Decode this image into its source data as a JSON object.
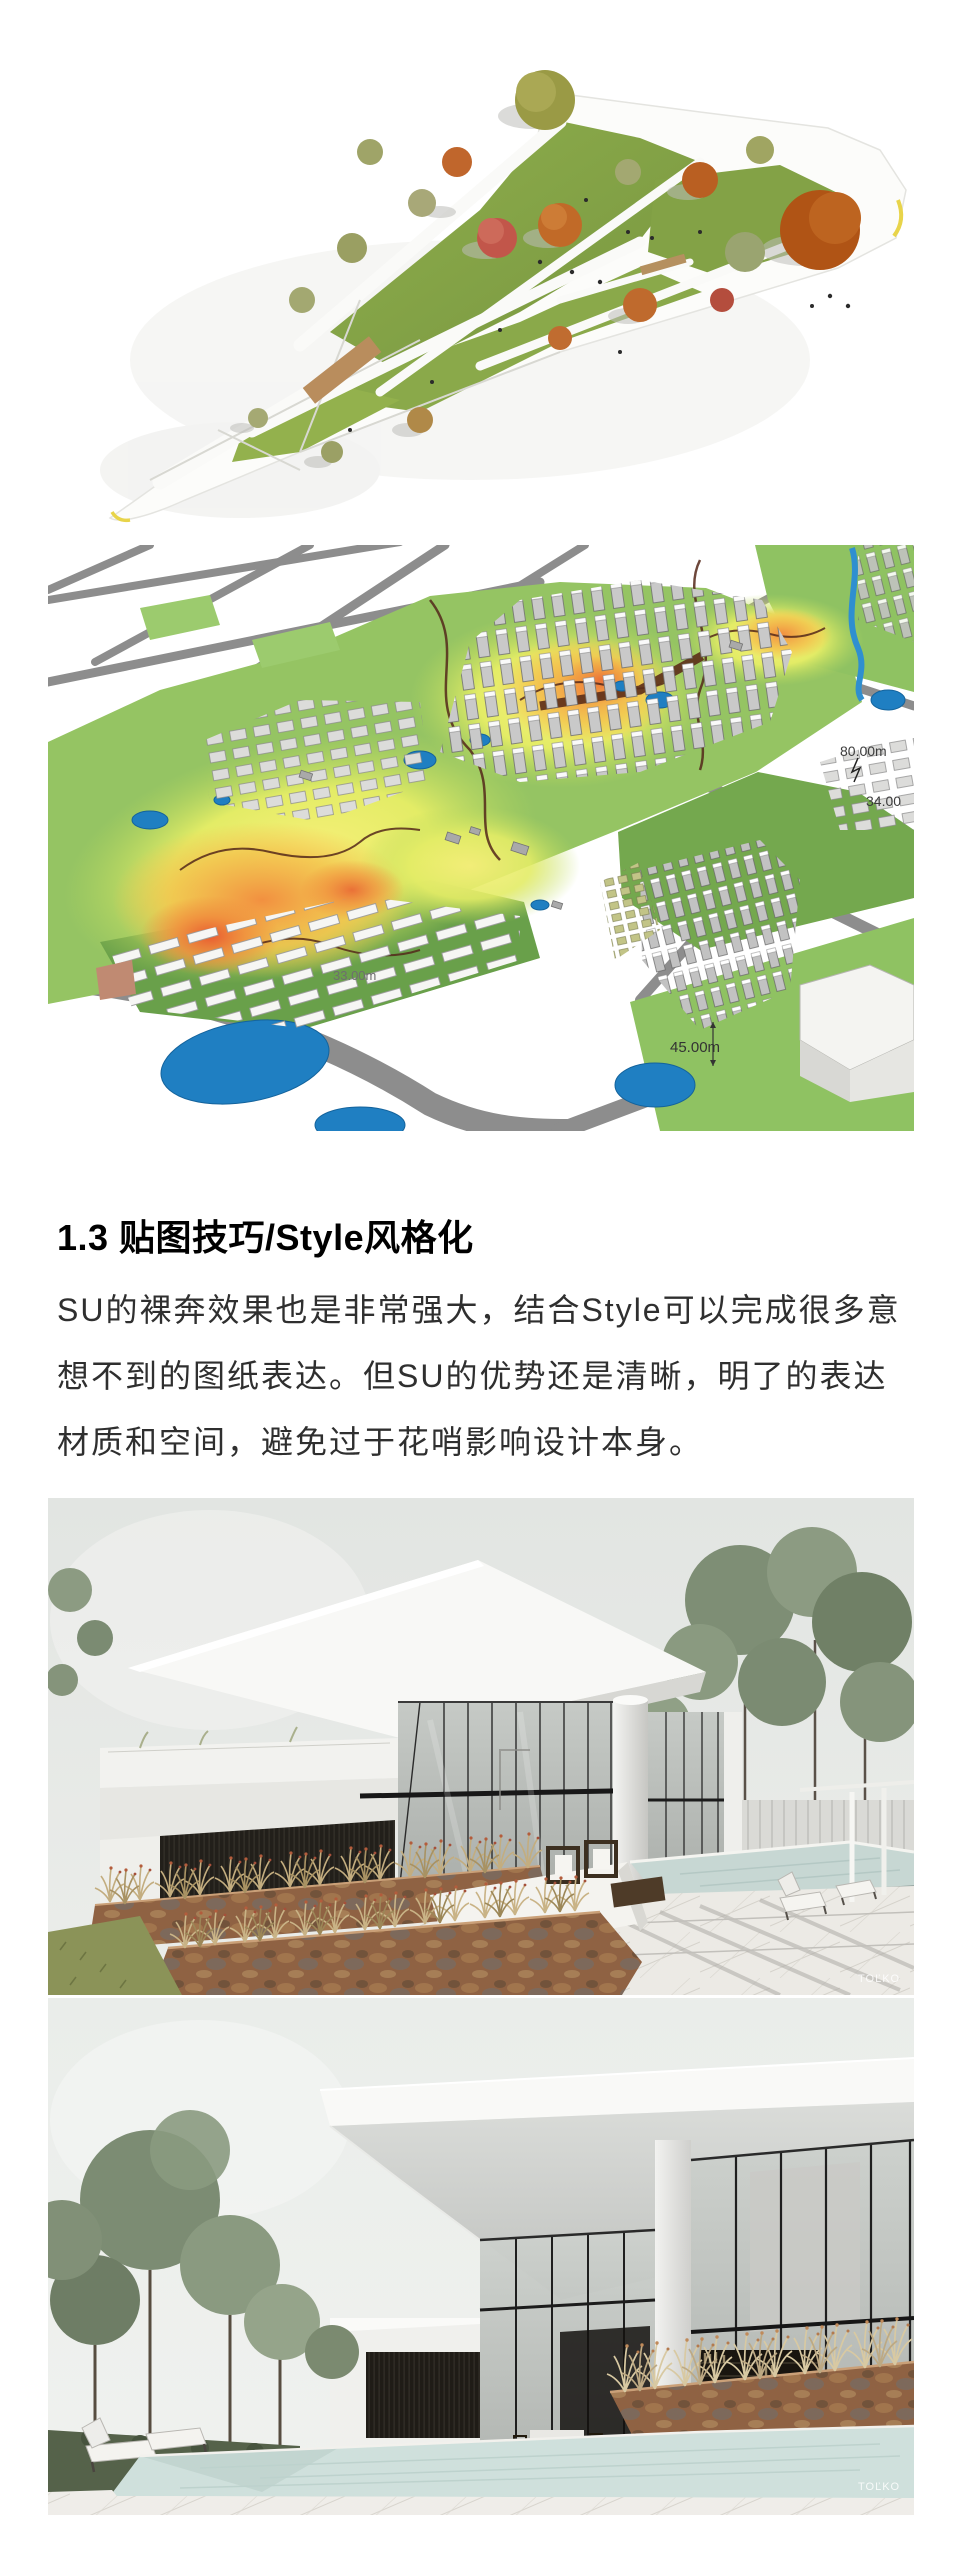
{
  "article": {
    "heading": "1.3 贴图技巧/Style风格化",
    "body_lines": [
      "SU的裸奔效果也是非常强大，结合Style可以完成很多意",
      "想不到的图纸表达。但SU的优势还是清晰，明了的表达",
      "材质和空间，避免过于花哨影响设计本身。"
    ]
  },
  "figures": {
    "park": {
      "name": "triangular-park-aerial-model"
    },
    "urban": {
      "name": "urban-terrain-heatmap-model",
      "labels": {
        "l80": "80.00m",
        "l34": "34.00",
        "l33": "33.00m",
        "l45": "45.00m"
      }
    },
    "villa1": {
      "name": "white-villa-terrace-render",
      "watermark": "TOĽKO"
    },
    "villa2": {
      "name": "white-villa-pool-render",
      "watermark": "TOĽKO"
    }
  }
}
